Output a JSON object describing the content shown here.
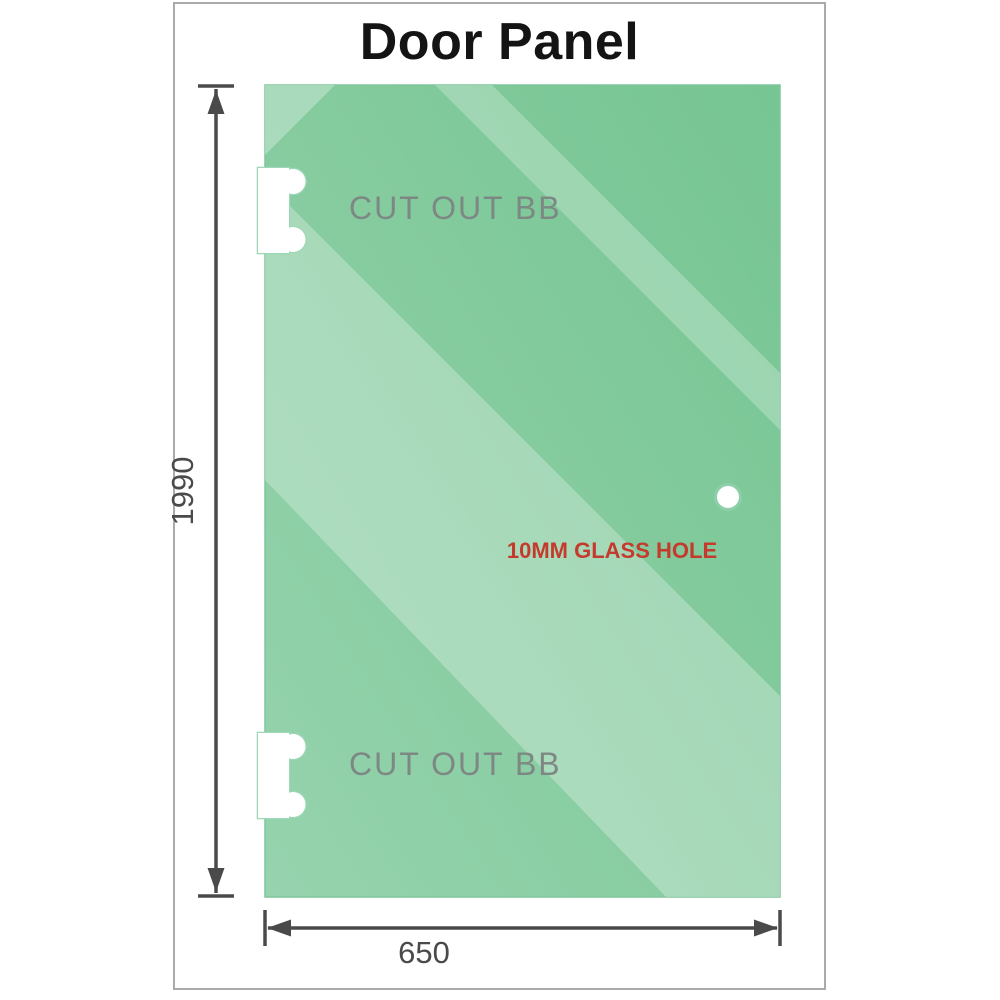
{
  "title": "Door Panel",
  "glass_panel": {
    "cutout_top_label": "CUT OUT BB",
    "cutout_bottom_label": "CUT OUT BB",
    "hole_label": "10MM GLASS HOLE"
  },
  "dimensions": {
    "height": "1990",
    "width": "650"
  },
  "colors": {
    "glass_green": "#8fd0a8",
    "glass_green_dark": "#76c592",
    "glass_sheen_pale": "#c9e7d3",
    "hole_label_red": "#c43b2e",
    "dimension_gray": "#4a4a4a",
    "cutout_label_gray": "#7d8884",
    "frame_border_gray": "#aaaaaa"
  }
}
